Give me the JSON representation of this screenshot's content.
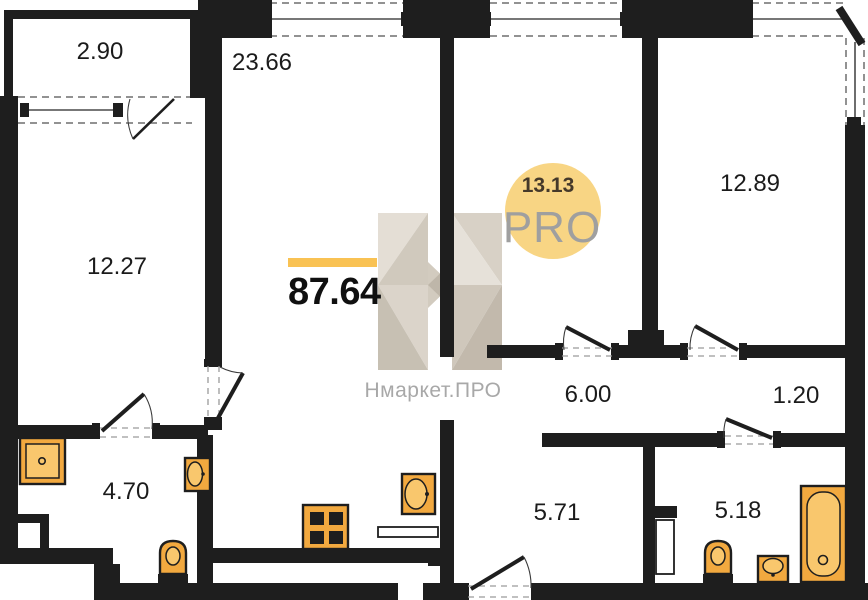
{
  "colors": {
    "wall": "#1e1e1e",
    "accent-bar": "#f9c253",
    "fixture": "#f2a93f",
    "fixture-light": "#f9c76d",
    "logo-circle": "#f8d584",
    "logo-text": "#9f9f9f",
    "watermark": "#a8a8a8"
  },
  "plan": {
    "total_area": "87.64",
    "rooms": [
      {
        "name": "balcony",
        "area": "2.90"
      },
      {
        "name": "living-room",
        "area": "23.66"
      },
      {
        "name": "bedroom-left",
        "area": "12.27"
      },
      {
        "name": "room-center",
        "area": "13.13"
      },
      {
        "name": "bedroom-right",
        "area": "12.89"
      },
      {
        "name": "hallway",
        "area": "6.00"
      },
      {
        "name": "closet",
        "area": "1.20"
      },
      {
        "name": "bathroom-left",
        "area": "4.70"
      },
      {
        "name": "corridor-kitchen",
        "area": "5.71"
      },
      {
        "name": "bathroom-right",
        "area": "5.18"
      }
    ],
    "fixtures": [
      "shower-tray",
      "sink",
      "toilet",
      "stove",
      "sink",
      "toilet",
      "sink",
      "bathtub"
    ],
    "branding": {
      "logo_text": "PRO",
      "watermark": "Нмаркет.ПРО"
    }
  }
}
